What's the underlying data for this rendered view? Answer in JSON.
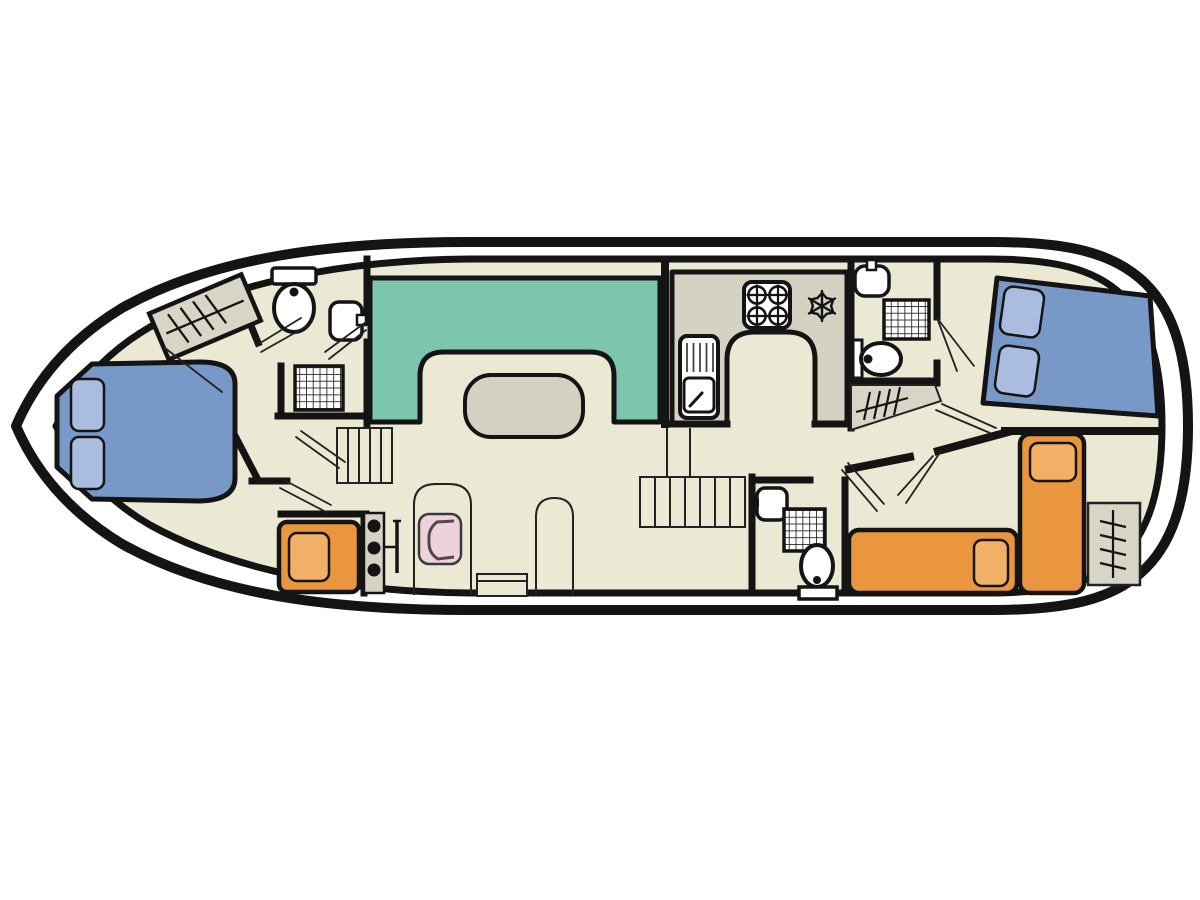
{
  "page": {
    "title": "houseboat-deck-plan",
    "background": "#ffffff"
  },
  "colors": {
    "hull_outline": "#141414",
    "deck": "#ffffff",
    "floor": "#ebe8d3",
    "wall": "#141414",
    "counter": "#d6d2c3",
    "table": "#d4d1c2",
    "wardrobe": "#d8d4c6",
    "dinette": "#7cc5ae",
    "bed_blue": "#7898c8",
    "pillow_blue": "#aabcdf",
    "bed_orange": "#e9963e",
    "pillow_orange": "#f2b066",
    "seat_pink": "#ecd2da",
    "seat_back": "#584349",
    "fixture": "#ffffff",
    "door_line": "#222222"
  },
  "plan": {
    "view": "top-down-deck-plan",
    "vessel": "canal-houseboat",
    "rooms": [
      {
        "name": "bow-cabin",
        "furniture": [
          "double-bed",
          "wardrobe"
        ]
      },
      {
        "name": "forward-bathroom",
        "furniture": [
          "toilet",
          "washbasin",
          "shower"
        ]
      },
      {
        "name": "forward-single-cabin",
        "furniture": [
          "single-bed"
        ]
      },
      {
        "name": "saloon",
        "furniture": [
          "u-shaped-dinette",
          "table",
          "helm-console",
          "helm-seat",
          "side-door",
          "step-locker"
        ]
      },
      {
        "name": "galley",
        "furniture": [
          "sink-with-drainer",
          "stove-4-burner",
          "refrigerator"
        ]
      },
      {
        "name": "midship-bathroom",
        "furniture": [
          "washbasin",
          "shower",
          "toilet",
          "wardrobe"
        ]
      },
      {
        "name": "aft-bathroom",
        "furniture": [
          "washbasin",
          "shower",
          "toilet"
        ]
      },
      {
        "name": "aft-double-cabin",
        "furniture": [
          "double-bed"
        ]
      },
      {
        "name": "aft-twin-cabin",
        "furniture": [
          "single-bed",
          "single-bed",
          "wardrobe"
        ]
      },
      {
        "name": "companionway-stairs",
        "count": 2
      }
    ]
  }
}
